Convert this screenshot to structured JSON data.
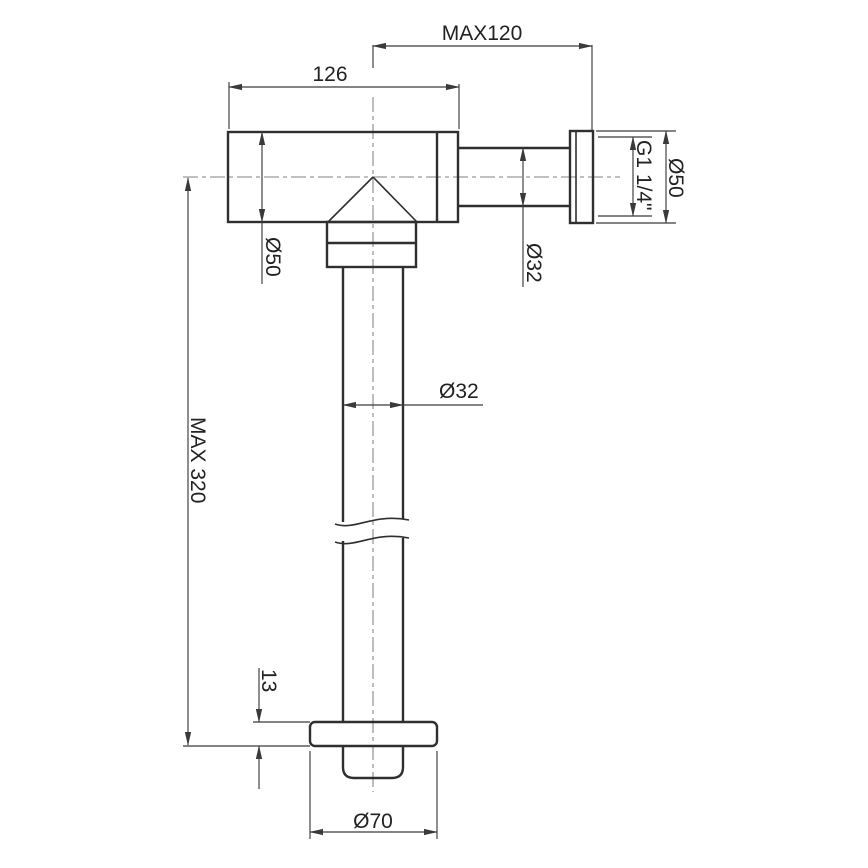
{
  "drawing": {
    "title": "flush-valve-technical-drawing",
    "labels": {
      "max_offset": "MAX120",
      "body_width": "126",
      "body_diameter": "Ø50",
      "inlet_pipe_diameter": "Ø32",
      "thread_size": "G1 1/4\"",
      "flange_diameter": "Ø50",
      "max_height": "MAX 320",
      "downpipe_diameter": "Ø32",
      "plate_thickness": "13",
      "plate_diameter": "Ø70"
    },
    "colors": {
      "background": "#ffffff",
      "object_line": "#2f2f2f",
      "dimension_line": "#3a3a3a",
      "centerline": "#9a9a9a",
      "text": "#222222"
    }
  }
}
